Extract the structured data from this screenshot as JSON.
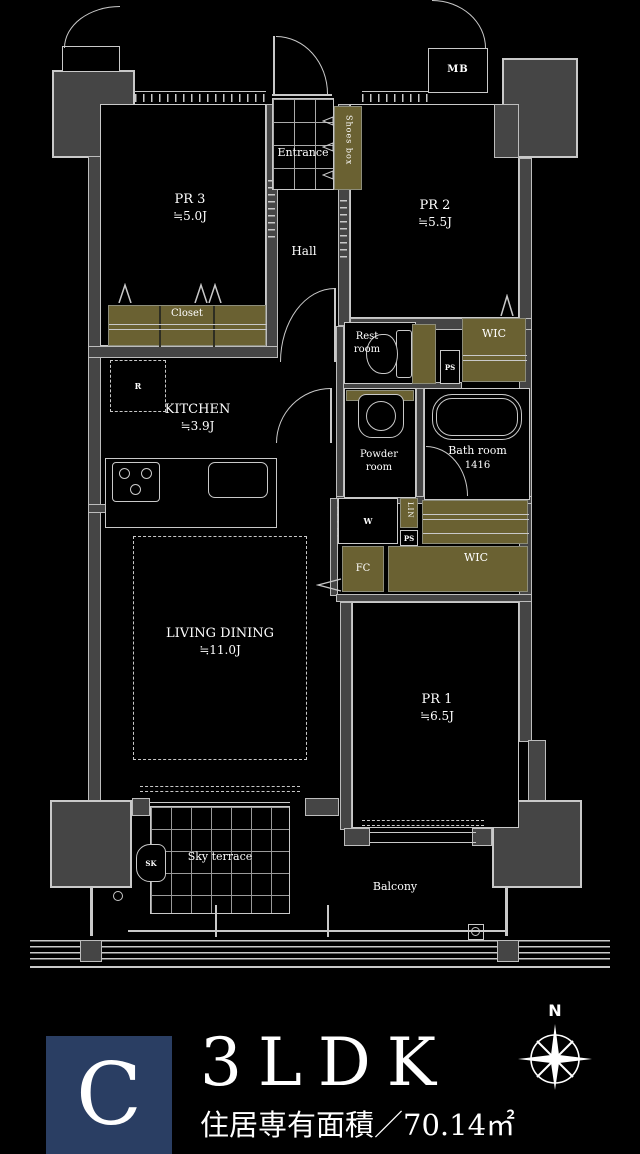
{
  "colors": {
    "background": "#000000",
    "wall_fill": "#454545",
    "plan_line": "#c9c9c9",
    "storage_fill": "#6a6132",
    "badge_navy": "#2a3e63",
    "text": "#ffffff"
  },
  "plan": {
    "rooms": {
      "pr3": {
        "name": "PR 3",
        "size": "≒5.0J"
      },
      "pr2": {
        "name": "PR 2",
        "size": "≒5.5J"
      },
      "pr1": {
        "name": "PR 1",
        "size": "≒6.5J"
      },
      "living_dining": {
        "name": "LIVING DINING",
        "size": "≒11.0J"
      },
      "kitchen": {
        "name": "KITCHEN",
        "size": "≒3.9J"
      },
      "bath": {
        "name": "Bath room",
        "size": "1416"
      },
      "powder": {
        "line1": "Powder",
        "line2": "room"
      },
      "rest": {
        "line1": "Rest",
        "line2": "room"
      },
      "hall": "Hall",
      "entrance": "Entrance",
      "sky_terrace": "Sky terrace",
      "balcony": "Balcony"
    },
    "storage": {
      "shoes_box": "Shoes box",
      "closet": "Closet",
      "wic_upper": "WIC",
      "wic_lower": "WIC",
      "fc": "FC",
      "lin": "LIN"
    },
    "equipment": {
      "mb": "MB",
      "ps_upper": "PS",
      "ps_lower": "PS",
      "w": "W",
      "r": "R",
      "sk": "SK"
    }
  },
  "footer": {
    "type_badge": "C",
    "layout": "3LDK",
    "area_label": "住居専有面積／70.14㎡",
    "compass_north": "N"
  }
}
